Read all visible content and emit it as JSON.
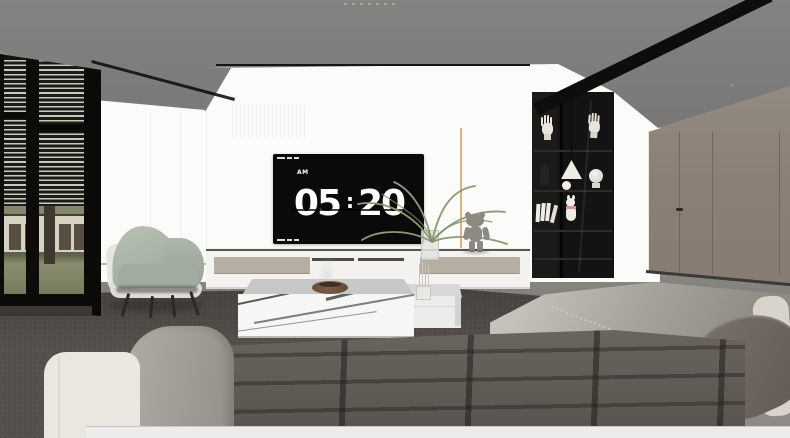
{
  "scene": {
    "description": "3D interior render of a modern living room at dawn",
    "room": "living-room"
  },
  "tv_clock": {
    "period": "AM",
    "hours": "05",
    "separator": ":",
    "minutes": "20"
  },
  "objects": [
    "ceiling-spotlights",
    "recessed-light-band",
    "venetian-blind-window",
    "outdoor-lawn-view",
    "accent-armchair",
    "tv-wall-panel",
    "flip-clock-tv",
    "media-console",
    "palm-plant",
    "bear-figurine",
    "display-shelf",
    "hand-sculptures",
    "pendant-lamp",
    "table-lamp",
    "books",
    "marble-coffee-table",
    "white-coffee-table",
    "incense-bowl",
    "dried-stems",
    "area-rug",
    "sectional-sofa",
    "tufted-seat",
    "dark-throw-pillow",
    "cream-throw-pillow",
    "concealed-door"
  ],
  "colors": {
    "ceiling": "#7d7c7a",
    "wall_white": "#fbfbf9",
    "wall_taupe": "#8b8179",
    "shelf_black": "#141313",
    "window_frame": "#0d0c0a",
    "blind_slat": "#c9cabe",
    "grass": "#7c8163",
    "building": "#d8d2c5",
    "chair_green": "#a9b3a6",
    "chair_shell": "#e4e3dd",
    "drawer_beige": "#b6aea1",
    "accent_gold": "#d8a46b",
    "tv_black": "#0a0a0a",
    "clock_text": "#ffffff",
    "marble": "#f6f6f4",
    "bowl_brown": "#6e563f",
    "rug": "#544f4a",
    "sofa_seat": "#5f5954",
    "sofa_back": "#a8a49e",
    "pillow_dark": "#6b645d",
    "pillow_cream": "#d9d4cb",
    "chaise_cream": "#eae7e1",
    "plinth_white": "#ececea",
    "bear_gray": "#8d8882",
    "plant_green": "#8b9c74"
  }
}
